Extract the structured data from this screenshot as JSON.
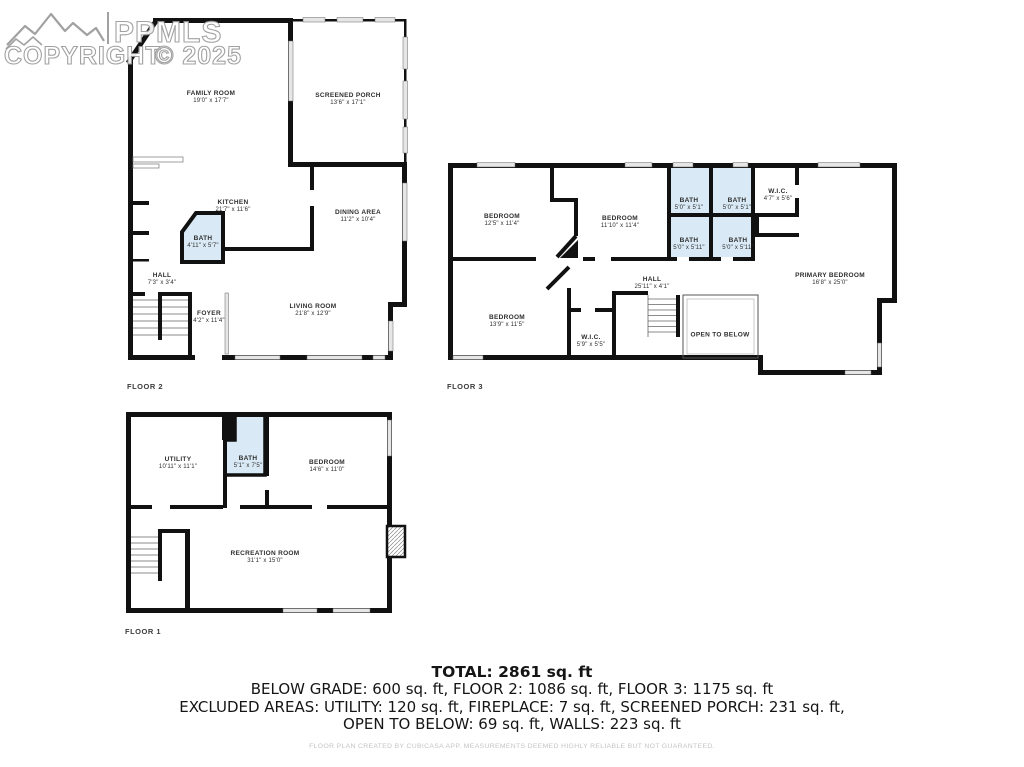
{
  "watermark": {
    "brand": "PPMLS",
    "copyright_word": "COPYRIGHT",
    "copyright_year": "© 2025",
    "logo": "mountain-range-icon"
  },
  "colors": {
    "wall": "#111111",
    "bath_fill": "#d9eaf6",
    "window_fill": "#e6e6e6",
    "label_text": "#2e2e2e",
    "watermark_stroke": "#9a9a9a",
    "disclaimer_text": "#c4c4c4"
  },
  "floors": {
    "floor2": {
      "label": "FLOOR 2",
      "rooms": {
        "family_room": {
          "name": "FAMILY ROOM",
          "dims": "19'0\" x 17'7\""
        },
        "screened_porch": {
          "name": "SCREENED PORCH",
          "dims": "13'6\" x 17'1\""
        },
        "kitchen": {
          "name": "KITCHEN",
          "dims": "21'7\" x 11'6\""
        },
        "bath": {
          "name": "BATH",
          "dims": "4'11\" x 5'7\""
        },
        "dining_area": {
          "name": "DINING AREA",
          "dims": "11'2\" x 10'4\""
        },
        "hall": {
          "name": "HALL",
          "dims": "7'3\" x 3'4\""
        },
        "foyer": {
          "name": "FOYER",
          "dims": "4'2\" x 11'4\""
        },
        "living_room": {
          "name": "LIVING ROOM",
          "dims": "21'8\" x 12'9\""
        }
      }
    },
    "floor3": {
      "label": "FLOOR 3",
      "rooms": {
        "bedroom_1": {
          "name": "BEDROOM",
          "dims": "12'5\" x 11'4\""
        },
        "bedroom_2": {
          "name": "BEDROOM",
          "dims": "11'10\" x 11'4\""
        },
        "bath_1": {
          "name": "BATH",
          "dims": "5'0\" x 5'1\""
        },
        "bath_2": {
          "name": "BATH",
          "dims": "5'0\" x 5'1\""
        },
        "bath_3": {
          "name": "BATH",
          "dims": "5'0\" x 5'11\""
        },
        "bath_4": {
          "name": "BATH",
          "dims": "5'0\" x 5'11\""
        },
        "wic_1": {
          "name": "W.I.C.",
          "dims": "4'7\" x 5'6\""
        },
        "hall": {
          "name": "HALL",
          "dims": "25'11\" x 4'1\""
        },
        "bedroom_3": {
          "name": "BEDROOM",
          "dims": "13'9\" x 11'5\""
        },
        "wic_2": {
          "name": "W.I.C.",
          "dims": "5'9\" x 5'5\""
        },
        "open_to_below": {
          "name": "OPEN TO BELOW"
        },
        "primary_bedroom": {
          "name": "PRIMARY BEDROOM",
          "dims": "16'8\" x 25'0\""
        }
      }
    },
    "floor1": {
      "label": "FLOOR 1",
      "rooms": {
        "utility": {
          "name": "UTILITY",
          "dims": "10'11\" x 11'1\""
        },
        "bath": {
          "name": "BATH",
          "dims": "5'1\" x 7'5\""
        },
        "bedroom": {
          "name": "BEDROOM",
          "dims": "14'6\" x 11'0\""
        },
        "recreation_room": {
          "name": "RECREATION ROOM",
          "dims": "31'1\" x 15'0\""
        }
      }
    }
  },
  "summary": {
    "total": "TOTAL: 2861 sq. ft",
    "line2": "BELOW GRADE: 600 sq. ft, FLOOR 2: 1086 sq. ft, FLOOR 3: 1175 sq. ft",
    "line3": "EXCLUDED AREAS: UTILITY: 120 sq. ft, FIREPLACE: 7 sq. ft, SCREENED PORCH: 231 sq. ft,",
    "line4": "OPEN TO BELOW: 69 sq. ft, WALLS: 223 sq. ft",
    "total_sqft": 2861,
    "below_grade_sqft": 600,
    "floor2_sqft": 1086,
    "floor3_sqft": 1175,
    "excluded": {
      "utility_sqft": 120,
      "fireplace_sqft": 7,
      "screened_porch_sqft": 231,
      "open_to_below_sqft": 69,
      "walls_sqft": 223
    }
  },
  "disclaimer": "FLOOR PLAN CREATED BY CUBICASA APP. MEASUREMENTS DEEMED HIGHLY RELIABLE BUT NOT GUARANTEED."
}
